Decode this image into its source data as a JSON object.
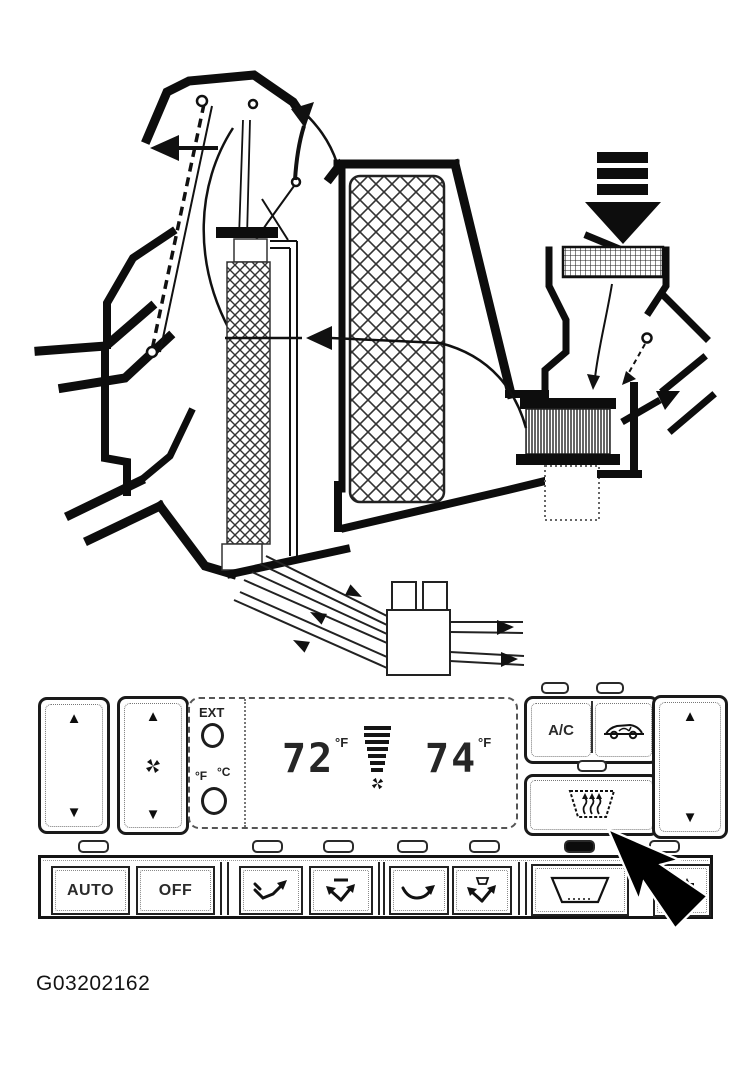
{
  "figure": {
    "caption": "G03202162"
  },
  "climate_panel": {
    "display": {
      "ext_label": "EXT",
      "fahrenheit_label": "°F",
      "celsius_label": "°C",
      "driver_temp": "72",
      "driver_temp_unit": "°F",
      "passenger_temp": "74",
      "passenger_temp_unit": "°F",
      "fan_bar_count": 7
    },
    "buttons": {
      "auto_label": "AUTO",
      "off_label": "OFF",
      "ac_label": "A/C",
      "up_glyph": "▲",
      "down_glyph": "▼"
    },
    "indicators": {
      "count": 7,
      "active": "front-defrost"
    }
  },
  "diagram": {
    "components": [
      "defroster-outlet",
      "windshield",
      "instrument-panel",
      "heater-core",
      "evaporator",
      "air-intake-arrow",
      "intake-grille",
      "blower-motor",
      "recirculation-door",
      "airflow-path",
      "heater-hoses",
      "hose-connector-box"
    ]
  }
}
